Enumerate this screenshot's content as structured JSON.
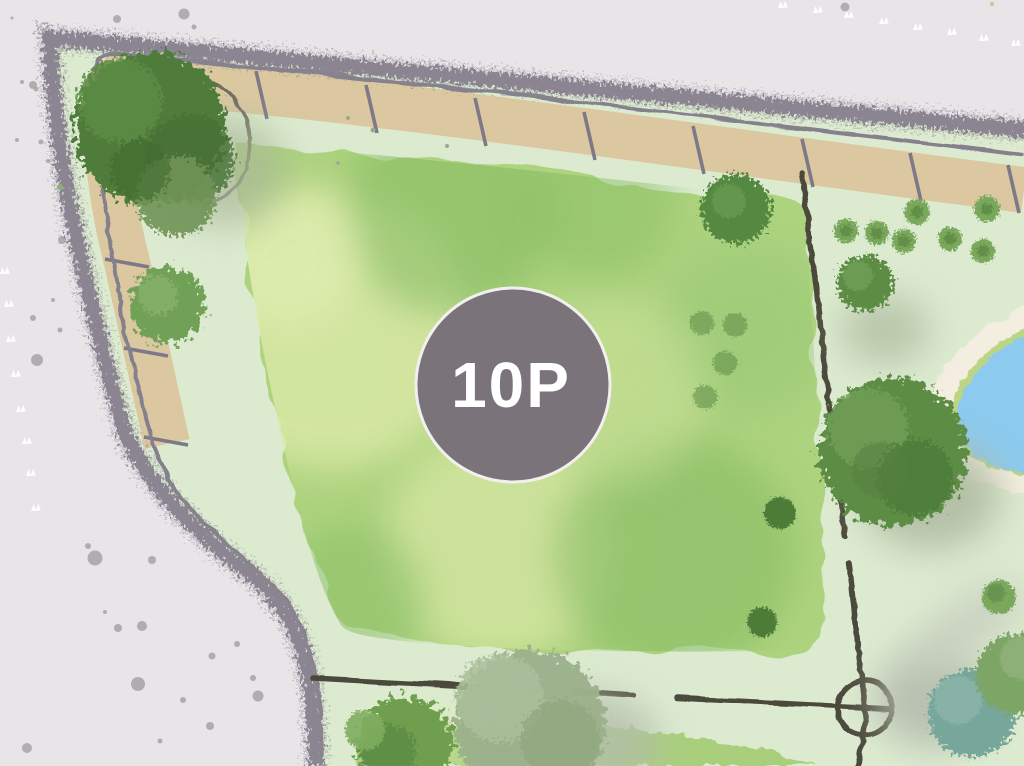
{
  "map": {
    "kind": "illustrated-site-plan",
    "marker": {
      "label": "10P"
    },
    "features": {
      "boundary": "scribbled-hedge-border",
      "parking": "parking-strip-with-stall-lines",
      "lawn": "main-lawn",
      "lower_lawn": "lower-lawn-band",
      "pond": "pond-with-sand-shore",
      "paths": "dashed-boundary-lines",
      "crosshair": "circle-crosshair-marker",
      "trees": "watercolor-trees-and-bushes"
    }
  },
  "colors": {
    "outside_pavement": "#e7e5e8",
    "boundary_hedge": "#8b8591",
    "edge_line": "#84808c",
    "parking_strip": "#dbc8a0",
    "stall_line": "#7e7989",
    "park_base": "#dcebd0",
    "lawn": "#aed37f",
    "lawn2": "#a9cf7c",
    "lawn_light": "#d9e8a6",
    "lawn_dark": "#86bc64",
    "tree_dark": "#4f7c3a",
    "tree_mid": "#5d8c45",
    "tree_light": "#79a75c",
    "tree_sage": "#9cb18c",
    "tree_teal": "#76a79a",
    "path_line": "#4b483b",
    "pond_water": "#8ccaef",
    "pond_sand": "#f3eee0",
    "pond_rim": "#bcd584",
    "marker_bg": "#7a747a",
    "marker_ring": "#f2f0ee",
    "marker_text": "#ffffff",
    "speck_white": "#ffffff",
    "speck_gray": "#aaa6ad"
  }
}
